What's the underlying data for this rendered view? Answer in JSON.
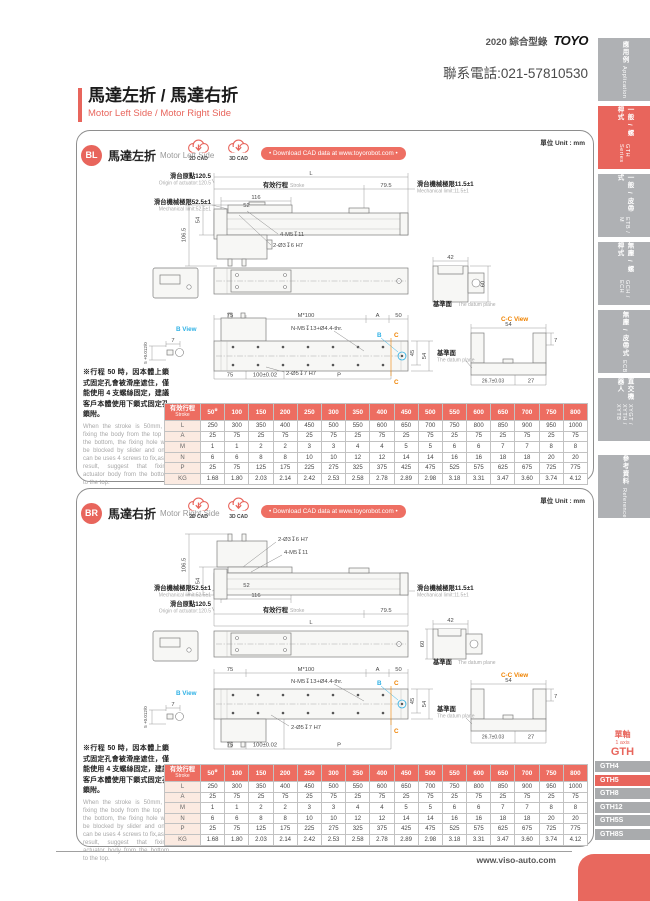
{
  "header": {
    "edition": "2020 綜合型錄",
    "brand": "TOYO",
    "phone": "聯系電話:021-57810530",
    "title_zh": "馬達左折 / 馬達右折",
    "title_en": "Motor Left Side / Motor Right Side"
  },
  "sidebar": {
    "tabs": [
      {
        "zh": "應用例",
        "en": "Application",
        "active": false
      },
      {
        "zh": "一般 / 螺桿式",
        "en": "GTH Series",
        "active": true
      },
      {
        "zh": "一般 / 皮帶式",
        "en": "ETB / M",
        "active": false
      },
      {
        "zh": "無塵 / 螺桿式",
        "en": "GCH / ECH",
        "active": false
      },
      {
        "zh": "無塵 / 皮帶式",
        "en": "ECB",
        "active": false
      },
      {
        "zh": "直交機器人",
        "en": "XYGT / XYTH / XYTB",
        "active": false
      },
      {
        "zh": "參考資料",
        "en": "Reference",
        "active": false
      }
    ]
  },
  "sections": [
    {
      "badge": "BL",
      "title_zh": "馬達左折",
      "title_en": "Motor Left Side"
    },
    {
      "badge": "BR",
      "title_zh": "馬達右折",
      "title_en": "Motor Right Side"
    }
  ],
  "cad": {
    "c2d": "2D CAD",
    "c3d": "3D CAD",
    "download": "• Download CAD data at www.toyorobot.com •"
  },
  "unit_label": "單位 Unit : mm",
  "note": {
    "zh": "※行程 50 時，因本體上鎖式固定孔會被滑座遮住，僅能使用 4 支螺絲固定，建議客戶本體使用下鎖式固定孔鎖附。",
    "en": "When the stroke is 50mm, if fixing the body from the top to the bottom, the fixing hole will be blocked by slider and only can be uses 4 screws to fix,as a result, suggest that fixing actuator body from the bottom to the top."
  },
  "drawing": {
    "origin_zh": "滑台原點120.5",
    "origin_en": "Origin of actuator:120.5",
    "mech_limit_left_zh": "滑台機械極限52.5±1",
    "mech_limit_left_en": "Mechanical limit:52.5±1",
    "mech_limit_right_zh": "滑台機械極限11.5±1",
    "mech_limit_right_en": "Mechanical limit:11.5±1",
    "stroke_zh": "有效行程",
    "stroke_en": "Stroke",
    "dim_L": "L",
    "dim_79_5": "79.5",
    "dim_116": "116",
    "dim_52": "52",
    "dim_106_5": "106.5",
    "dim_54": "54",
    "screw_top1": "4-M5↧11",
    "screw_top2": "2-Ø3↧6 H7",
    "dim_42": "42",
    "dim_60": "60",
    "datum_zh": "基準面",
    "datum_en": "The datum plane",
    "dim_75": "75",
    "dim_M100": "M*100",
    "dim_A": "A",
    "dim_50": "50",
    "hole_note": "N-M5↧13+Ø4.4-thr.",
    "b_view": "B View",
    "dim_7": "7",
    "pin_tol": "5 +0.012/0",
    "marker_B": "B",
    "marker_C": "C",
    "dim_45": "45",
    "dim_100tol": "100±0.02",
    "dim_P": "P",
    "bolt_note": "2-Ø5↧7 H7",
    "cc_view": "C-C View",
    "dim_26_7": "26.7±0.03",
    "dim_27": "27"
  },
  "spec_table": {
    "header_zh": "有效行程",
    "header_en": "Stroke",
    "stroke_note_mark": "※",
    "strokes": [
      "50",
      "100",
      "150",
      "200",
      "250",
      "300",
      "350",
      "400",
      "450",
      "500",
      "550",
      "600",
      "650",
      "700",
      "750",
      "800"
    ],
    "rows": [
      {
        "label": "L",
        "values": [
          "250",
          "300",
          "350",
          "400",
          "450",
          "500",
          "550",
          "600",
          "650",
          "700",
          "750",
          "800",
          "850",
          "900",
          "950",
          "1000"
        ]
      },
      {
        "label": "A",
        "values": [
          "25",
          "75",
          "25",
          "75",
          "25",
          "75",
          "25",
          "75",
          "25",
          "75",
          "25",
          "75",
          "25",
          "75",
          "25",
          "75"
        ]
      },
      {
        "label": "M",
        "values": [
          "1",
          "1",
          "2",
          "2",
          "3",
          "3",
          "4",
          "4",
          "5",
          "5",
          "6",
          "6",
          "7",
          "7",
          "8",
          "8"
        ]
      },
      {
        "label": "N",
        "values": [
          "6",
          "6",
          "8",
          "8",
          "10",
          "10",
          "12",
          "12",
          "14",
          "14",
          "16",
          "16",
          "18",
          "18",
          "20",
          "20"
        ]
      },
      {
        "label": "P",
        "values": [
          "25",
          "75",
          "125",
          "175",
          "225",
          "275",
          "325",
          "375",
          "425",
          "475",
          "525",
          "575",
          "625",
          "675",
          "725",
          "775"
        ]
      },
      {
        "label": "KG",
        "values": [
          "1.68",
          "1.80",
          "2.03",
          "2.14",
          "2.42",
          "2.53",
          "2.58",
          "2.78",
          "2.89",
          "2.98",
          "3.18",
          "3.31",
          "3.47",
          "3.60",
          "3.74",
          "4.12"
        ]
      }
    ]
  },
  "series_nav": {
    "group_zh": "單軸",
    "group_en": "1 axis",
    "group_code": "GTH",
    "items": [
      {
        "label": "GTH4",
        "active": false
      },
      {
        "label": "GTH5",
        "active": true
      },
      {
        "label": "GTH8",
        "active": false
      },
      {
        "label": "GTH12",
        "active": false
      },
      {
        "label": "GTH5S",
        "active": false
      },
      {
        "label": "GTH8S",
        "active": false
      }
    ]
  },
  "footer": {
    "url": "www.viso-auto.com"
  }
}
